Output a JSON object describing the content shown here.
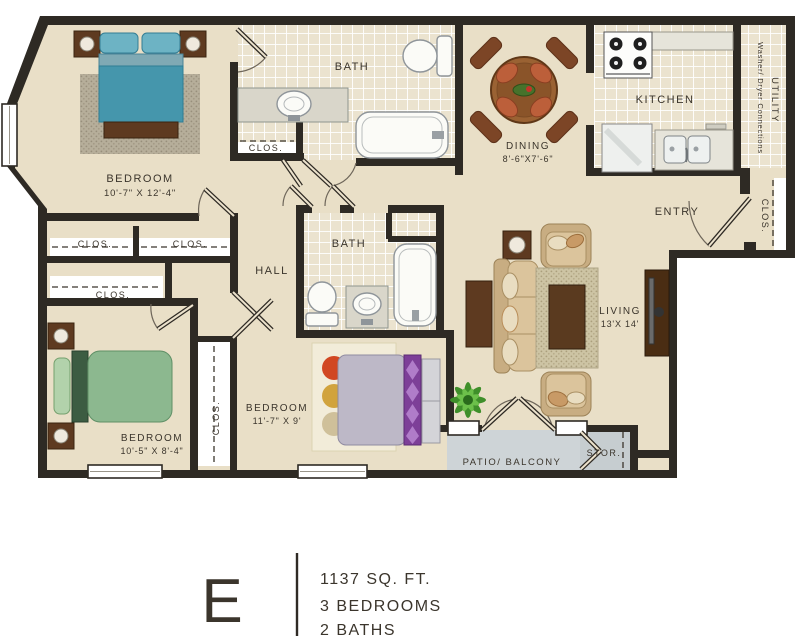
{
  "floorplan": {
    "rooms": {
      "bedroom1": {
        "label": "BEDROOM",
        "dims": "10'-7\" X 12'-4\""
      },
      "bedroom2": {
        "label": "BEDROOM",
        "dims": "10'-5\" X 8'-4\""
      },
      "bedroom3": {
        "label": "BEDROOM",
        "dims": "11'-7\" X 9'"
      },
      "bath1": {
        "label": "BATH"
      },
      "bath2": {
        "label": "BATH"
      },
      "dining": {
        "label": "DINING",
        "dims": "8'-6\"X7'-6\""
      },
      "kitchen": {
        "label": "KITCHEN"
      },
      "utility": {
        "label": "UTILITY",
        "sub": "Washer/ Dryer Connections"
      },
      "entry": {
        "label": "ENTRY"
      },
      "hall": {
        "label": "HALL"
      },
      "living": {
        "label": "LIVING",
        "dims": "13'X 14'"
      },
      "patio": {
        "label": "PATIO/ BALCONY"
      },
      "storage": {
        "label": "STOR."
      }
    },
    "closets": {
      "bath1": "CLOS.",
      "row1a": "CLOS.",
      "row1b": "CLOS.",
      "row2": "CLOS.",
      "bedroom3": "CLOS.",
      "entry": "CLOS."
    },
    "legend": {
      "plan_letter": "E",
      "area": "1137 SQ. FT.",
      "bedrooms": "3 BEDROOMS",
      "baths": "2 BATHS"
    },
    "colors": {
      "wall": "#2e2a24",
      "floor": "#e9dfc7",
      "tile": "#ece4d0",
      "patio": "#ced4d7",
      "storage_floor": "#c6cdd0",
      "wood": "#5e3a20",
      "bed_teal": "#4596ac",
      "bed_green": "#8cb88f",
      "bed_purple": "#7d3f98",
      "sofa": "#dbc49c",
      "text": "#3b352c"
    }
  }
}
